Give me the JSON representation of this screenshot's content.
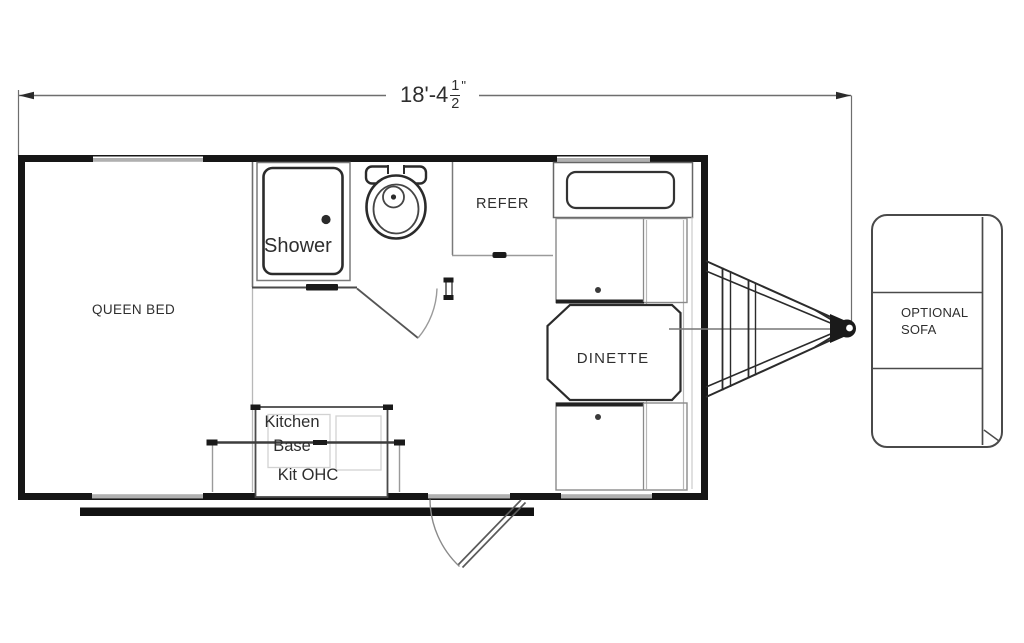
{
  "dimension": {
    "feet_inches": "18'-4",
    "fraction_numerator": "1",
    "fraction_denominator": "2",
    "inch_mark": "\""
  },
  "labels": {
    "queen_bed": "QUEEN BED",
    "shower": "Shower",
    "refer": "REFER",
    "dinette": "DINETTE",
    "kitchen_line1": "Kitchen",
    "kitchen_line2": "Base",
    "kit_ohc": "Kit OHC",
    "sofa_line1": "OPTIONAL",
    "sofa_line2": "SOFA"
  },
  "icons": {
    "toilet": "toilet-icon",
    "shower_stall": "shower-stall-icon",
    "hitch": "trailer-hitch-icon",
    "entry_door": "door-swing-icon"
  },
  "colors": {
    "wall": "#161616",
    "line_dark": "#2b2b2b",
    "line_mid": "#6e6e6e",
    "line_light": "#b0b0b0",
    "background": "#ffffff",
    "text": "#2e2e2e"
  }
}
